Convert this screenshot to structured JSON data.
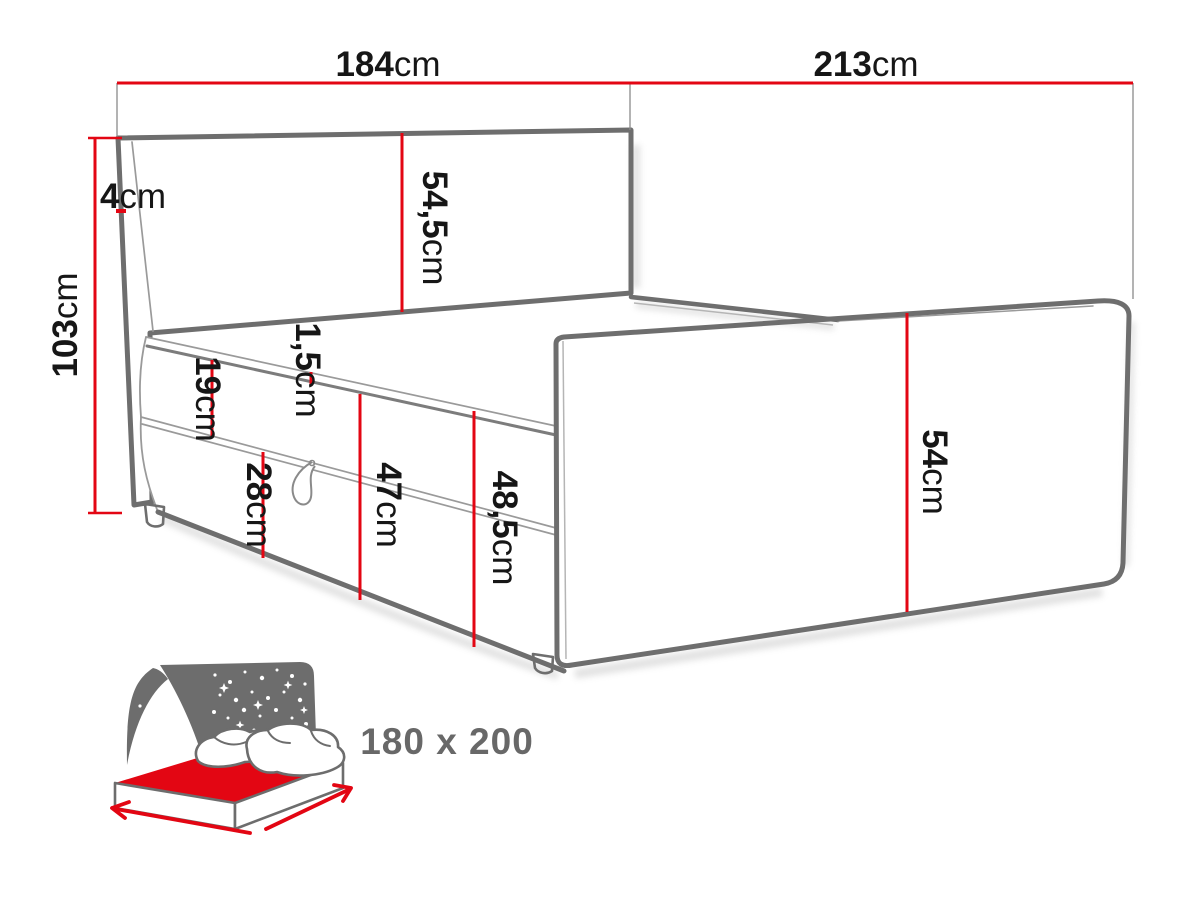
{
  "diagram": {
    "type": "bed-dimension-drawing",
    "dims": {
      "width_head": {
        "value": "184",
        "unit": "cm"
      },
      "length_side": {
        "value": "213",
        "unit": "cm"
      },
      "headboard_frame": {
        "value": "4",
        "unit": "cm"
      },
      "height_total": {
        "value": "103",
        "unit": "cm"
      },
      "headboard_face": {
        "value": "54,5",
        "unit": "cm"
      },
      "mattress_side": {
        "value": "19",
        "unit": "cm"
      },
      "topper_lip": {
        "value": "1,5",
        "unit": "cm"
      },
      "box_side": {
        "value": "28",
        "unit": "cm"
      },
      "side_inner": {
        "value": "47",
        "unit": "cm"
      },
      "side_outer": {
        "value": "48,5",
        "unit": "cm"
      },
      "footboard_face": {
        "value": "54",
        "unit": "cm"
      }
    },
    "size_label": "180 x 200",
    "colors": {
      "dim_red": "#e30613",
      "outline_dark": "#6e6e6e",
      "outline_mid": "#9a9a9a",
      "label_black": "#161616",
      "icon_gray": "#6d6d6d",
      "size_text_gray": "#686868"
    }
  }
}
